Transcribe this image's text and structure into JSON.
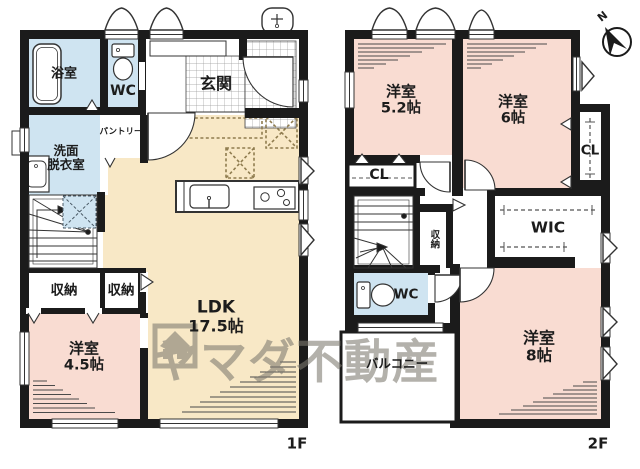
{
  "colors": {
    "bedroom_pink": "#f9dcd2",
    "ldk_cream": "#f8e8c6",
    "wet_blue": "#cfe4f1",
    "wall_black": "#1b1b1b",
    "dashed_accent": "#8f7c4f",
    "watermark_gray": "#7d7a70"
  },
  "watermark": {
    "text": "ヤマダ不動産"
  },
  "compass": {
    "north": "N"
  },
  "floor1": {
    "label": "1F",
    "bath": "浴室",
    "wc": "WC",
    "entrance": "玄関",
    "washroom_l1": "洗面",
    "washroom_l2": "脱衣室",
    "pantry": "パントリー",
    "storage_a": "収納",
    "storage_b": "収納",
    "ldk_l1": "LDK",
    "ldk_l2": "17.5帖",
    "bedroom_l1": "洋室",
    "bedroom_l2": "4.5帖"
  },
  "floor2": {
    "label": "2F",
    "bedroom52_l1": "洋室",
    "bedroom52_l2": "5.2帖",
    "bedroom6_l1": "洋室",
    "bedroom6_l2": "6帖",
    "closet_a": "CL",
    "closet_b": "CL",
    "wic": "WIC",
    "storage": "収納",
    "wc": "WC",
    "balcony": "バルコニー",
    "bedroom8_l1": "洋室",
    "bedroom8_l2": "8帖"
  }
}
